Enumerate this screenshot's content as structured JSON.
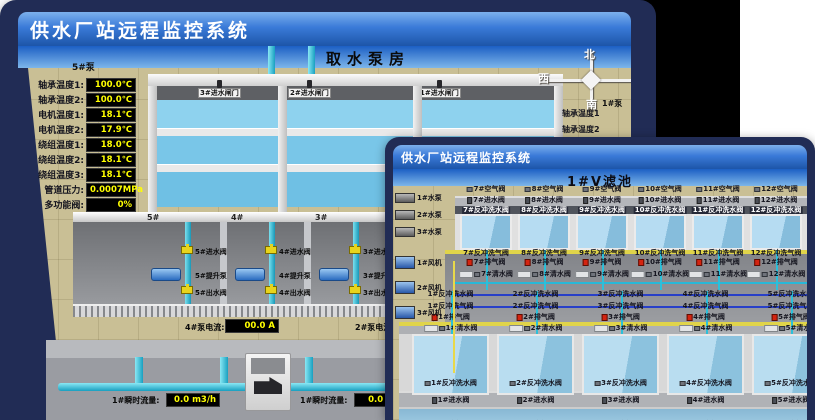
{
  "colors": {
    "frame_navy": "#212c55",
    "titlebar_blue": "#3a7ad8",
    "ground_tan": "#c9bf95",
    "value_yellow": "#ffff00",
    "alarm_red": "#d42410",
    "pipe_cyan": "#18a0c0",
    "water_blue": "#8ed2ee"
  },
  "back_window": {
    "titlebar": "供水厂站远程监控系统",
    "scene_title": "取水泵房",
    "panel": {
      "header": "5#泵",
      "rows": [
        {
          "label": "轴承温度1:",
          "value": "100.0℃"
        },
        {
          "label": "轴承温度2:",
          "value": "100.0℃"
        },
        {
          "label": "电机温度1:",
          "value": "18.1℃"
        },
        {
          "label": "电机温度2:",
          "value": "17.9℃"
        },
        {
          "label": "绕组温度1:",
          "value": "18.0℃"
        },
        {
          "label": "绕组温度2:",
          "value": "18.1℃"
        },
        {
          "label": "绕组温度3:",
          "value": "18.1℃"
        },
        {
          "label": "管道压力:",
          "value": "0.0007MPa"
        },
        {
          "label": "多功能阀:",
          "value": "0%"
        }
      ]
    },
    "gates": [
      {
        "label": "3#进水闸门"
      },
      {
        "label": "2#进水闸门"
      },
      {
        "label": "1#进水闸门"
      }
    ],
    "compass": {
      "north": "北",
      "west": "西",
      "south": "南"
    },
    "right_panel": {
      "header": "1#泵",
      "labels": [
        {
          "label": "轴承温度1"
        },
        {
          "label": "轴承温度2"
        }
      ]
    },
    "bays": [
      {
        "id": "5#",
        "inlet": "5#进水阀",
        "pump": "5#提升泵",
        "outlet": "5#出水阀"
      },
      {
        "id": "4#",
        "inlet": "4#进水阀",
        "pump": "4#提升泵",
        "outlet": "4#出水阀"
      },
      {
        "id": "3#",
        "inlet": "3#进水阀",
        "pump": "3#提升泵",
        "outlet": "3#出水阀"
      }
    ],
    "current_left": {
      "label": "4#泵电流:",
      "value": "00.0 A"
    },
    "current_right": {
      "label": "2#泵电流"
    },
    "flow_left": {
      "label": "1#瞬时流量:",
      "value": "0.0 m3/h"
    },
    "flow_right": {
      "label": "1#瞬时流量:",
      "value": "0.0 m3/"
    }
  },
  "front_window": {
    "titlebar": "供水厂站远程监控系统",
    "scene_title": "1#V滤池",
    "equipment": [
      {
        "label": "1#水泵"
      },
      {
        "label": "2#水泵"
      },
      {
        "label": "3#水泵"
      },
      {
        "label": "1#风机"
      },
      {
        "label": "2#风机"
      },
      {
        "label": "3#风机"
      }
    ],
    "top_filters": [
      {
        "air": "7#空气阀",
        "inlet": "7#进水阀",
        "bw_water": "7#反冲洗水阀",
        "bw_air": "7#反冲洗气阀",
        "exhaust": "7#排气阀",
        "clean": "7#清水阀"
      },
      {
        "air": "8#空气阀",
        "inlet": "8#进水阀",
        "bw_water": "8#反冲洗水阀",
        "bw_air": "8#反冲洗气阀",
        "exhaust": "8#排气阀",
        "clean": "8#清水阀"
      },
      {
        "air": "9#空气阀",
        "inlet": "9#进水阀",
        "bw_water": "9#反冲洗水阀",
        "bw_air": "9#反冲洗气阀",
        "exhaust": "9#排气阀",
        "clean": "9#清水阀"
      },
      {
        "air": "10#空气阀",
        "inlet": "10#进水阀",
        "bw_water": "10#反冲洗水阀",
        "bw_air": "10#反冲洗气阀",
        "exhaust": "10#排气阀",
        "clean": "10#清水阀"
      },
      {
        "air": "11#空气阀",
        "inlet": "11#进水阀",
        "bw_water": "11#反冲洗水阀",
        "bw_air": "11#反冲洗气阀",
        "exhaust": "11#排气阀",
        "clean": "11#清水阀"
      },
      {
        "air": "12#空气阀",
        "inlet": "12#进水阀",
        "bw_water": "12#反冲洗水阀",
        "bw_air": "12#反冲洗气阀",
        "exhaust": "12#排气阀",
        "clean": "12#清水阀"
      }
    ],
    "bottom_filters": [
      {
        "bw_water": "1#反冲洗水阀",
        "bw_air": "1#反冲洗气阀",
        "exhaust": "1#排气阀",
        "clean": "1#清水阀",
        "pool_valve": "1#反冲洗水阀",
        "inlet": "1#进水阀",
        "air": "1#空气阀"
      },
      {
        "bw_water": "2#反冲洗水阀",
        "bw_air": "2#反冲洗气阀",
        "exhaust": "2#排气阀",
        "clean": "2#清水阀",
        "pool_valve": "2#反冲洗水阀",
        "inlet": "2#进水阀",
        "air": "2#空气阀"
      },
      {
        "bw_water": "3#反冲洗水阀",
        "bw_air": "3#反冲洗气阀",
        "exhaust": "3#排气阀",
        "clean": "3#清水阀",
        "pool_valve": "3#反冲洗水阀",
        "inlet": "3#进水阀",
        "air": "3#空气阀"
      },
      {
        "bw_water": "4#反冲洗水阀",
        "bw_air": "4#反冲洗气阀",
        "exhaust": "4#排气阀",
        "clean": "4#清水阀",
        "pool_valve": "4#反冲洗水阀",
        "inlet": "4#进水阀",
        "air": "4#空气阀"
      },
      {
        "bw_water": "5#反冲洗水阀",
        "bw_air": "5#反冲洗气阀",
        "exhaust": "5#排气阀",
        "clean": "5#清水阀",
        "pool_valve": "5#反冲洗水阀",
        "inlet": "5#进水阀",
        "air": "5#空气阀"
      }
    ]
  }
}
